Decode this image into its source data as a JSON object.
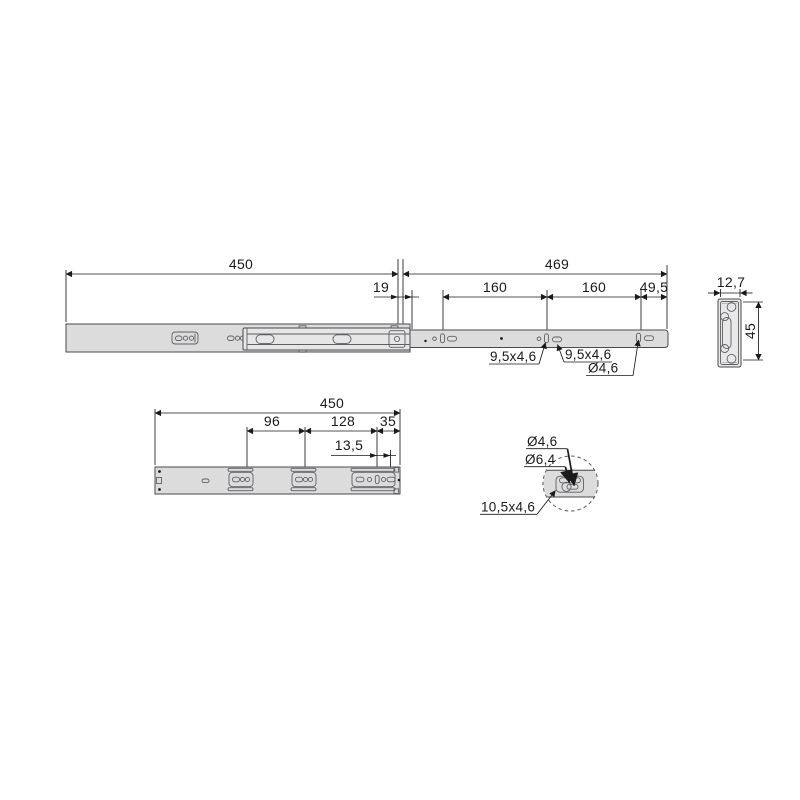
{
  "drawing_title": "telescopic drawer slide dimensional drawing",
  "colors": {
    "rail_fill": "#dcdcdc",
    "inner_rail_fill": "#e6e6e6",
    "line": "#1a1a1a",
    "object_line": "#4a4a4e",
    "background": "#ffffff"
  },
  "top_view": {
    "length_drawer_member": "450",
    "length_cabinet_member": "469",
    "front_offset": "19",
    "hole_pitch_1": "160",
    "hole_pitch_2": "160",
    "rear_offset": "49,5",
    "slot_label_1": "9,5x4,6",
    "slot_label_2": "9,5x4,6",
    "hole_label": "Ø4,6"
  },
  "cross_section": {
    "width": "12,7",
    "height": "45"
  },
  "bottom_view": {
    "length": "450",
    "pitch_front": "96",
    "pitch_mid": "128",
    "rear_offset": "35",
    "hole_pitch": "13,5"
  },
  "detail_view": {
    "hole_small": "Ø4,6",
    "hole_large": "Ø6,4",
    "slot_label": "10,5x4,6"
  }
}
